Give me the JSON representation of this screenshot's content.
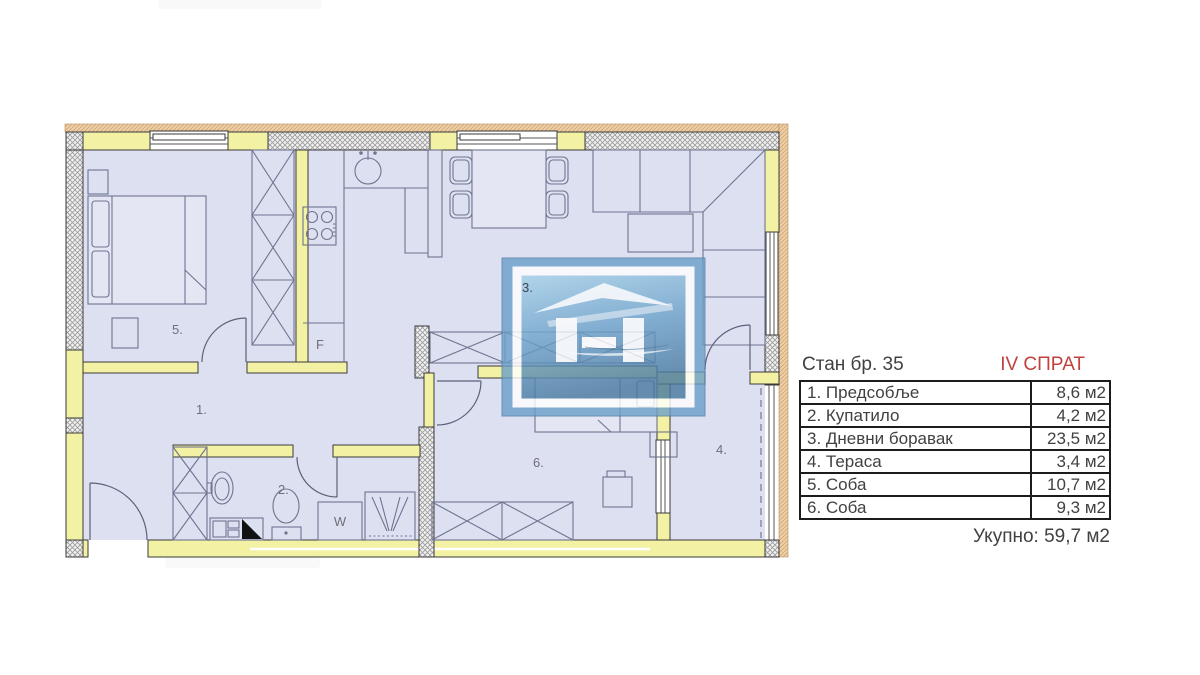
{
  "legend": {
    "title": "Стан бр. 35",
    "floor_label": "IV СПРАТ",
    "rows": [
      {
        "label": "1. Предсобље",
        "area": "8,6 м2"
      },
      {
        "label": "2. Купатило",
        "area": "4,2 м2"
      },
      {
        "label": "3. Дневни боравак",
        "area": "23,5 м2"
      },
      {
        "label": "4. Тераса",
        "area": "3,4 м2"
      },
      {
        "label": "5. Соба",
        "area": "10,7 м2"
      },
      {
        "label": "6. Соба",
        "area": "9,3 м2"
      }
    ],
    "total": "Укупно: 59,7 м2",
    "colors": {
      "floor_label": "#c0413d",
      "text": "#414141",
      "border": "#1c1c1c"
    }
  },
  "floorplan": {
    "room_labels": {
      "hallway": "1.",
      "bathroom": "2.",
      "living_room": "3.",
      "terrace": "4.",
      "bedroom_5": "5.",
      "bedroom_6": "6."
    },
    "appliance_labels": {
      "fridge": "F",
      "washing_machine": "W"
    },
    "colors": {
      "floor": "#dde0f1",
      "interior_wall": "#f3f1a3",
      "facade_band": "#eccda4",
      "furniture_line": "#6f7490",
      "logo_blue": "#6b9fc8"
    }
  }
}
